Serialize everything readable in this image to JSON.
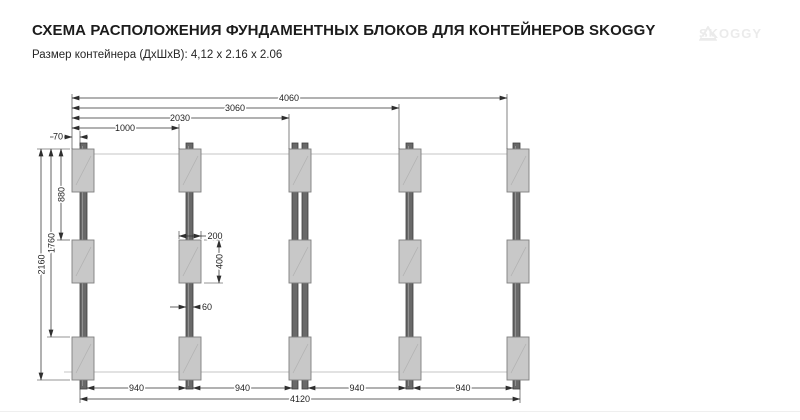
{
  "header": {
    "title": "СХЕМА РАСПОЛОЖЕНИЯ ФУНДАМЕНТНЫХ БЛОКОВ ДЛЯ КОНТЕЙНЕРОВ SKOGGY",
    "subtitle": "Размер контейнера (ДхШхВ): 4,12 x 2.16 x 2.06",
    "brand": "SKOGGY"
  },
  "diagram": {
    "top_dimensions": [
      "4060",
      "3060",
      "2030",
      "1000"
    ],
    "edge_offset_dimension": "70",
    "left_dimensions": [
      "2160",
      "1760",
      "880"
    ],
    "block": {
      "width_label": "200",
      "height_label": "400",
      "tape_width_label": "60"
    },
    "bottom_spacings": [
      "940",
      "940",
      "940",
      "940"
    ],
    "bottom_total": "4120",
    "structure": {
      "columns": 5,
      "rows": 3
    },
    "colors": {
      "block_fill": "#c8c8c8",
      "tape_fill": "#696969",
      "dimension_line": "#2f2f2f",
      "container_outline": "#c4c4c4"
    }
  }
}
